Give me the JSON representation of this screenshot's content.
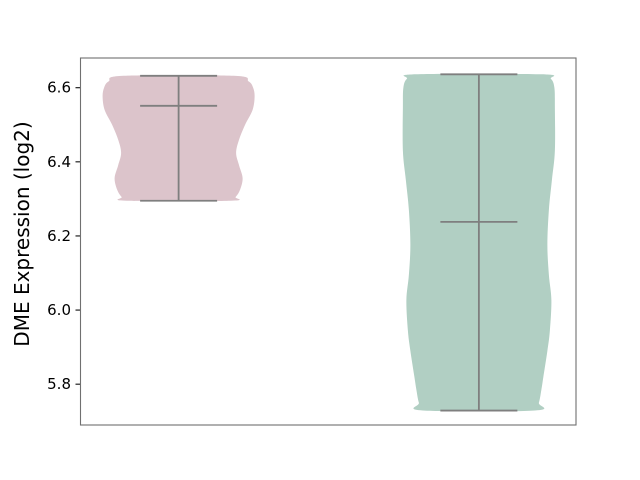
{
  "window": {
    "background": "#ffffff"
  },
  "chart_data": {
    "type": "violin",
    "title": "",
    "xlabel": "",
    "ylabel": "DME Expression (log2)",
    "ylim": [
      5.69,
      6.68
    ],
    "yticks": [
      5.8,
      6.0,
      6.2,
      6.4,
      6.6
    ],
    "ytick_labels": [
      "5.8",
      "6.0",
      "6.2",
      "6.4",
      "6.6"
    ],
    "xtick_labels": [],
    "grid": false,
    "legend": "none",
    "axis_color": "#707070",
    "tick_color": "#333333",
    "text_color": "#000000",
    "inner_line_color": "#7f7f7f",
    "violins": [
      {
        "name": "group-1",
        "fill_color": "#dcc4cb",
        "center_frac": 0.198,
        "cap_half_px": 38.5,
        "stats": {
          "min": 6.295,
          "median": 6.551,
          "max": 6.632
        },
        "width_profile": [
          [
            6.632,
            55.0
          ],
          [
            6.617,
            70.0
          ],
          [
            6.6,
            74.5
          ],
          [
            6.576,
            76.0
          ],
          [
            6.54,
            74.0
          ],
          [
            6.5,
            66.5
          ],
          [
            6.46,
            60.5
          ],
          [
            6.424,
            57.5
          ],
          [
            6.39,
            60.5
          ],
          [
            6.356,
            64.0
          ],
          [
            6.325,
            61.5
          ],
          [
            6.305,
            57.0
          ],
          [
            6.295,
            52.0
          ]
        ]
      },
      {
        "name": "group-2",
        "fill_color": "#b1cfc3",
        "center_frac": 0.804,
        "cap_half_px": 38.5,
        "stats": {
          "min": 5.729,
          "median": 6.238,
          "max": 6.636
        },
        "width_profile": [
          [
            6.636,
            63.0
          ],
          [
            6.624,
            72.0
          ],
          [
            6.6,
            75.5
          ],
          [
            6.545,
            76.0
          ],
          [
            6.43,
            76.0
          ],
          [
            6.35,
            73.0
          ],
          [
            6.27,
            70.0
          ],
          [
            6.176,
            68.5
          ],
          [
            6.095,
            70.0
          ],
          [
            6.027,
            72.5
          ],
          [
            5.945,
            71.0
          ],
          [
            5.89,
            68.5
          ],
          [
            5.82,
            64.5
          ],
          [
            5.785,
            62.5
          ],
          [
            5.75,
            60.0
          ],
          [
            5.729,
            56.0
          ]
        ]
      }
    ]
  }
}
